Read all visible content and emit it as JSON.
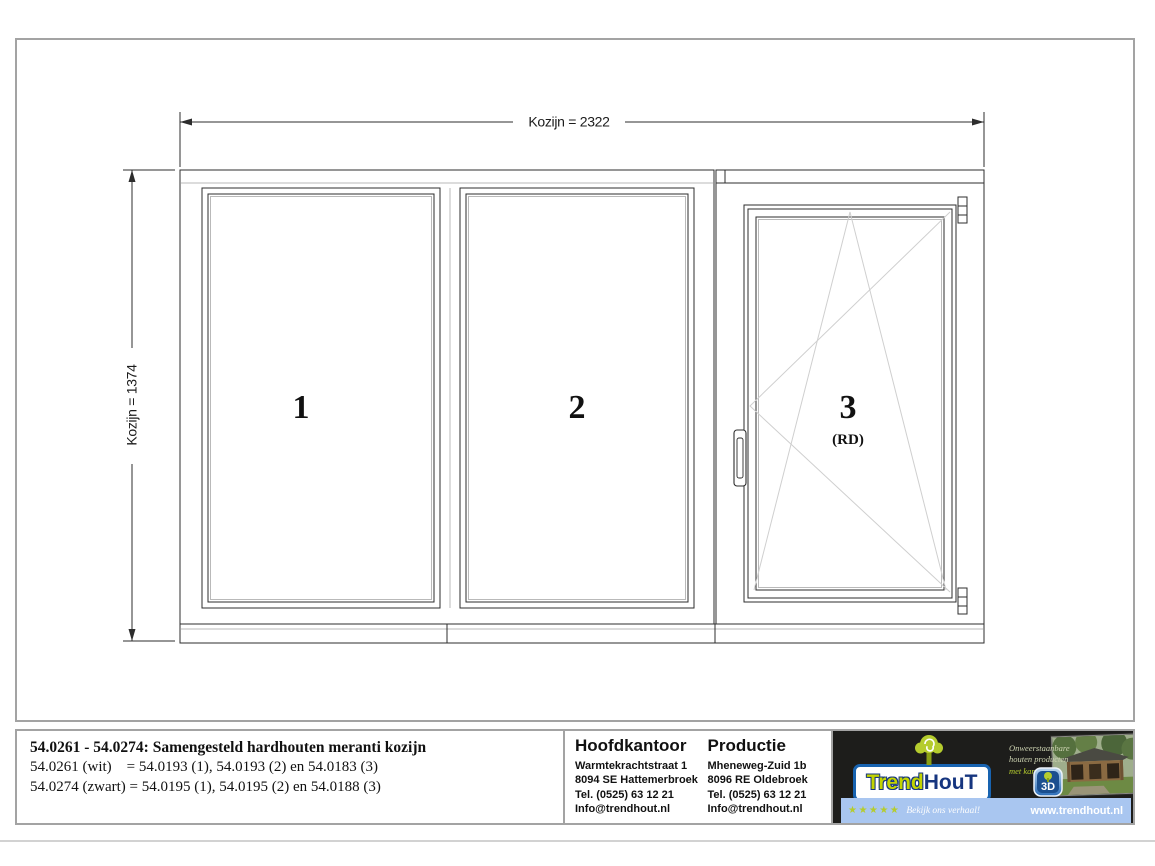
{
  "drawing": {
    "dimensions": {
      "width_label": "Kozijn = 2322",
      "height_label": "Kozijn = 1374"
    },
    "panels": [
      {
        "label": "1"
      },
      {
        "label": "2"
      },
      {
        "label": "3",
        "sub_label": "(RD)"
      }
    ]
  },
  "title_block": {
    "title": "54.0261 - 54.0274: Samengesteld hardhouten meranti kozijn",
    "line2": "54.0261 (wit)    = 54.0193 (1), 54.0193 (2) en 54.0183 (3)",
    "line3": "54.0274 (zwart) = 54.0195 (1), 54.0195 (2) en 54.0188 (3)"
  },
  "contact": {
    "hoofdkantoor": {
      "heading": "Hoofdkantoor",
      "address1": "Warmtekrachtstraat 1",
      "address2": "8094 SE Hattemerbroek",
      "phone": "Tel. (0525) 63 12 21",
      "email": "Info@trendhout.nl"
    },
    "productie": {
      "heading": "Productie",
      "address1": "Mheneweg-Zuid 1b",
      "address2": "8096 RE Oldebroek",
      "phone": "Tel. (0525) 63 12 21",
      "email": "Info@trendhout.nl"
    }
  },
  "branding": {
    "logo_part1": "Trend",
    "logo_part2": "HouT",
    "slogan_line1": "Onweerstaanbare",
    "slogan_line2": "houten producten",
    "slogan_line3": "met karakter",
    "badge_label": "3D",
    "review_stars": "★★★★★",
    "review_text": "Bekijk ons verhaal!",
    "website": "www.trendhout.nl",
    "colors": {
      "lime": "#b5cc2e",
      "navy": "#16357f",
      "strip_blue": "#a9c6f0",
      "panel_black": "#1d1d1b"
    }
  }
}
